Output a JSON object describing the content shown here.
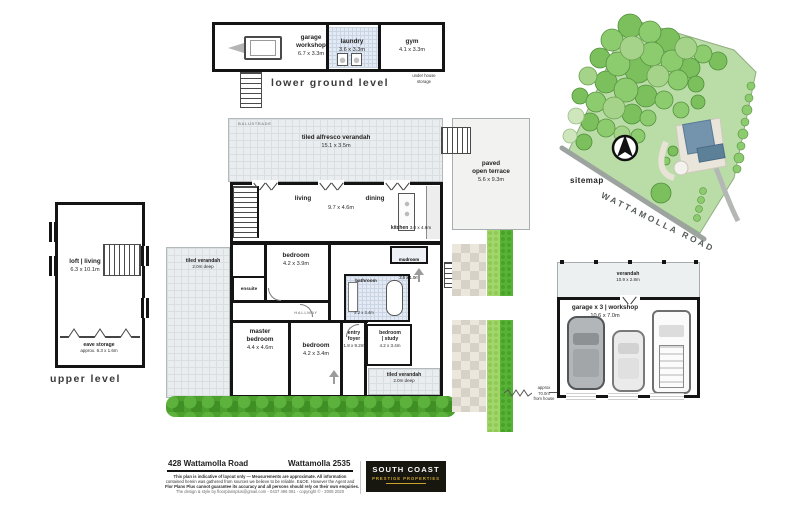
{
  "colors": {
    "wall": "#141414",
    "tile": "#eaedef",
    "wet_tile": "#e3eaf3",
    "hedge_dark": "#4ba02e",
    "hedge_light": "#a3d66a",
    "tree_green": "#7cc05e",
    "site_ground": "#badda7",
    "road_gray": "#9da4a0",
    "terrace": "#f2f2f0",
    "paver": "#d6d2c8",
    "logo_bg": "#17160f",
    "logo_gold": "#c9a22b",
    "arrow_gray": "#9b9b9b"
  },
  "lower_ground_level": {
    "title": "lower ground level",
    "garage_workshop_name": "garage\nworkshop",
    "garage_workshop_dim": "6.7 x 3.3m",
    "laundry_name": "laundry",
    "laundry_dim": "3.6 x 3.3m",
    "gym_name": "gym",
    "gym_dim": "4.1 x 3.3m",
    "under_house_storage": "under house\nstorage"
  },
  "upper_level": {
    "title": "upper level",
    "loft_name": "loft | living",
    "loft_dim": "6.3 x 10.1m",
    "eave_name": "eave storage",
    "eave_dim": "approx. 6.3 x 1.6m"
  },
  "main_level": {
    "balustrade": "BALUSTRADE",
    "alfresco_name": "tiled alfresco verandah",
    "alfresco_dim": "15.1 x 3.5m",
    "living": "living",
    "dining": "dining",
    "living_dining_dim": "9.7 x 4.6m",
    "kitchen_name": "kitchen",
    "kitchen_dim": "3.0 x 4.6m",
    "mudroom_name": "mudroom",
    "mudroom_dim": "3.5 x 1.0m",
    "bathroom_name": "bathroom",
    "bathroom_dim": "4.2 x 3.4m",
    "verandah_left_name": "tiled verandah",
    "verandah_left_dim": "2.0m deep",
    "bedroom1_name": "bedroom",
    "bedroom1_dim": "4.2 x 3.9m",
    "ensuite": "ensuite",
    "master_name": "master\nbedroom",
    "master_dim": "4.4 x 4.6m",
    "bedroom2_name": "bedroom",
    "bedroom2_dim": "4.2 x 3.4m",
    "entry_name": "entry\nfoyer",
    "entry_dim": "1.8 x 9.2m",
    "study_name": "bedroom\n| study",
    "study_dim": "4.2 x 3.4m",
    "verandah_bottom_name": "tiled verandah",
    "verandah_bottom_dim": "2.0m deep",
    "hallway": "HALLWAY",
    "terrace_name": "paved\nopen terrace",
    "terrace_dim": "5.6 x 9.3m"
  },
  "garage_building": {
    "verandah_name": "verandah",
    "verandah_dim": "10.9 x 2.8m",
    "garage_name": "garage x 3 | workshop",
    "garage_dim": "10.6 x 7.0m",
    "distance": "approx\n70.0m\nfrom house"
  },
  "sitemap": {
    "label": "sitemap",
    "road": "WATTAMOLLA ROAD"
  },
  "footer": {
    "address": "428 Wattamolla Road",
    "locality": "Wattamolla  2535",
    "disclaimer1": "This plan is indicative of layout only  —  Measurements are approximate. All information",
    "disclaimer2": "contained herein was gathered from sources we believe to be reliable. E&OE. However the Agent and",
    "disclaimer3": "Flor Plans Plus cannot guarantee its accuracy and all persons should rely on their own enquiries.",
    "disclaimer4": "The design & style by floorplansplus@gmail.com - 0437 496 061 - copyright © - 2005 2020",
    "logo_top": "SOUTH COAST",
    "logo_bottom": "PRESTIGE PROPERTIES"
  }
}
